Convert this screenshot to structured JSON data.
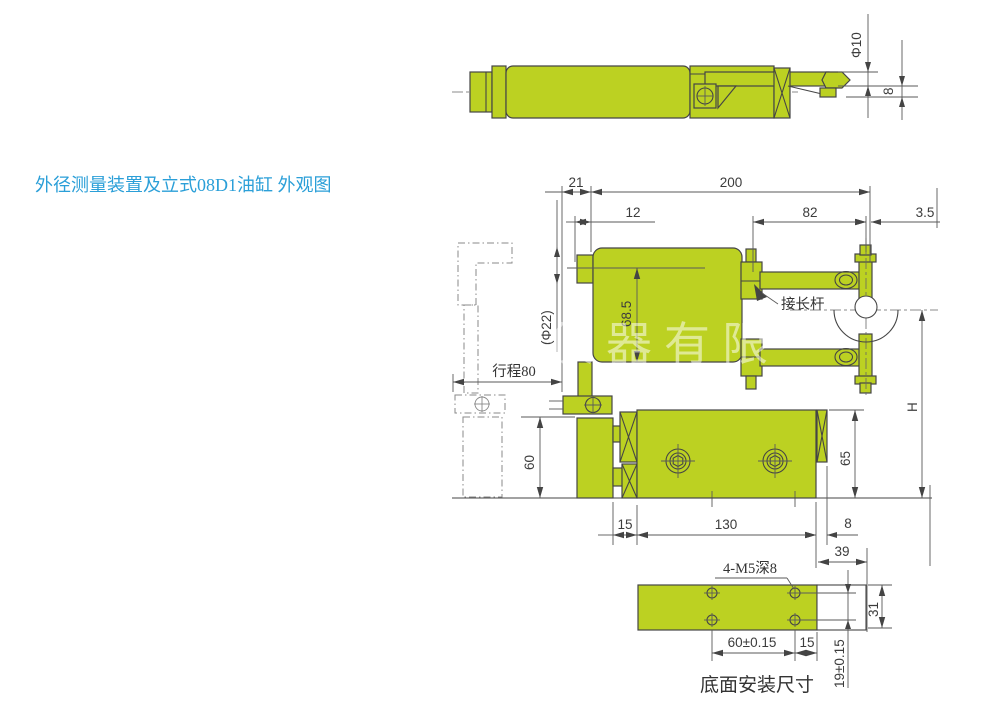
{
  "title": "外径测量装置及立式08D1油缸 外观图",
  "watermark": "仪器有限",
  "colors": {
    "part_green": "#bcd122",
    "line_gray": "#4a4a4a",
    "title_blue": "#2b9fd8"
  },
  "top_view": {
    "dia_rod": "Φ10",
    "tip_height": "8"
  },
  "main_view": {
    "dim_21": "21",
    "dim_200": "200",
    "dim_12": "12",
    "dim_82": "82",
    "dim_3_5": "3.5",
    "dim_68_5": "68.5",
    "dim_dia22": "(Φ22)",
    "dim_stroke": "行程80",
    "label_extension_rod": "接长杆",
    "dim_60": "60",
    "dim_65": "65",
    "dim_H": "H",
    "dim_15": "15",
    "dim_130": "130",
    "dim_8": "8",
    "dim_39": "39"
  },
  "bottom_view": {
    "label_holes": "4-M5深8",
    "dim_60": "60±0.15",
    "dim_15": "15",
    "dim_31": "31",
    "dim_19": "19±0.15",
    "caption": "底面安装尺寸"
  }
}
